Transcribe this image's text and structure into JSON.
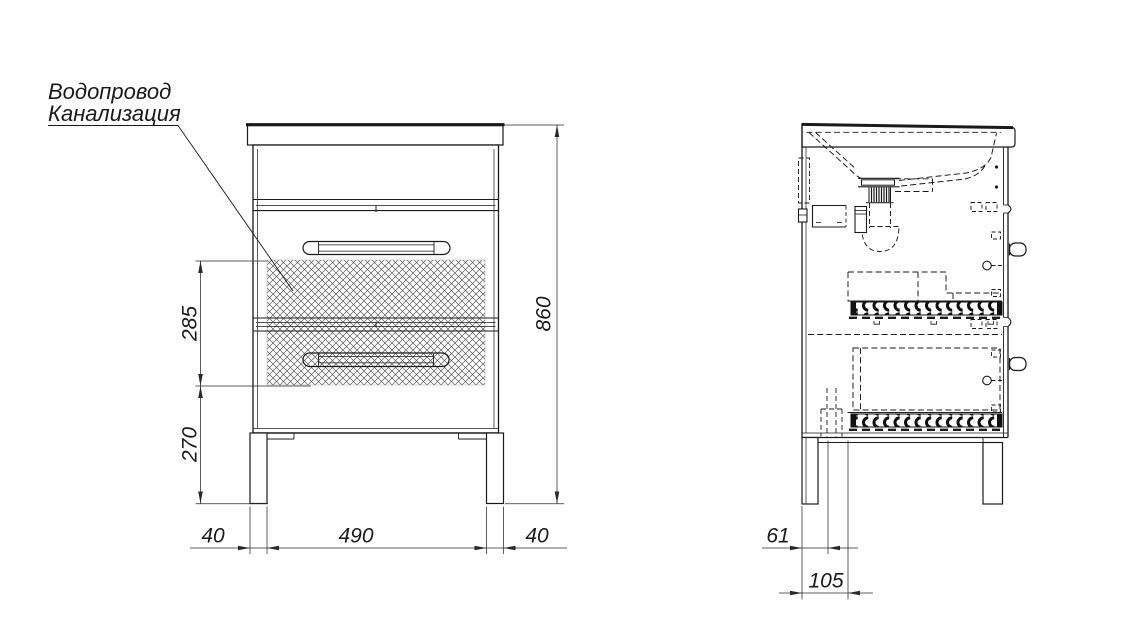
{
  "colors": {
    "line": "#1a1a1a",
    "dim": "#2a2a2a",
    "background": "#ffffff"
  },
  "callout": {
    "line1": "Водопровод",
    "line2": "Канализация"
  },
  "front": {
    "height_total": "860",
    "pipe_zone_height": "285",
    "bottom_zone_height": "270",
    "leg_width_left": "40",
    "leg_span": "490",
    "leg_width_right": "40"
  },
  "side": {
    "pipe_offset_near": "61",
    "pipe_offset_far": "105"
  }
}
